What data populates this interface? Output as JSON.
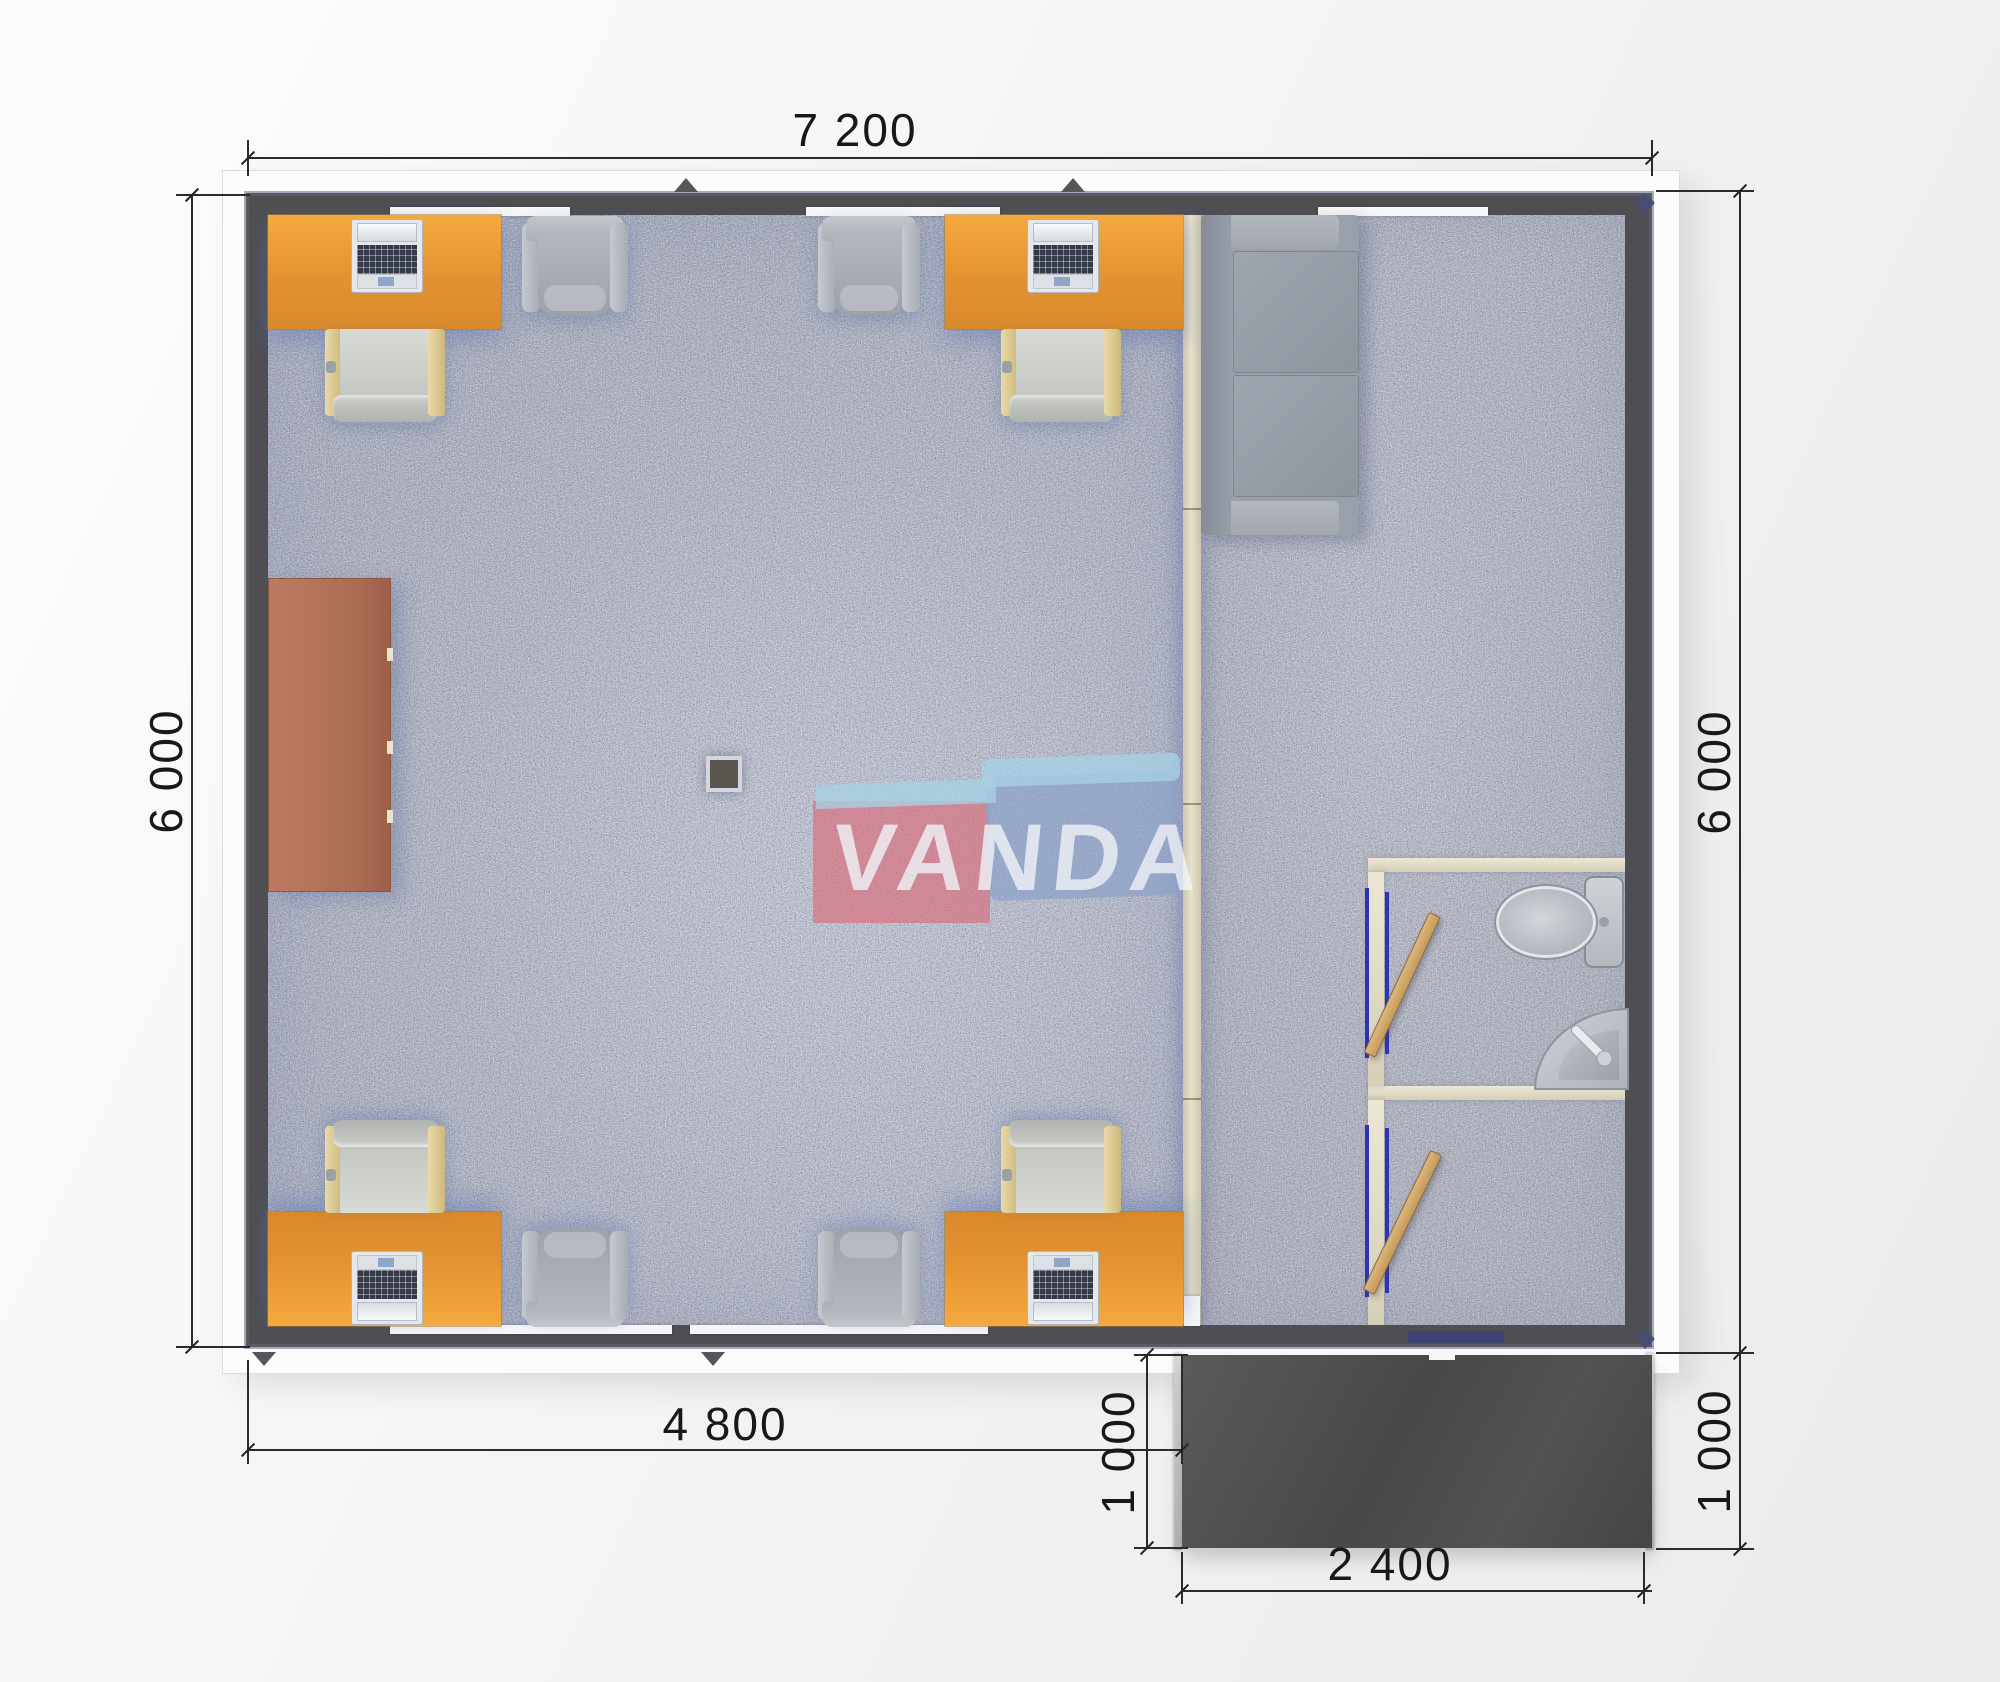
{
  "plan": {
    "type": "modular-office-floor-plan",
    "watermark": {
      "text": "VANDA"
    },
    "dimension_labels": {
      "top_width": "7 200",
      "left_height": "6 000",
      "right_height": "6 000",
      "bottom_office_width": "4 800",
      "porch_depth_left": "1 000",
      "porch_depth_right": "1 000",
      "porch_width": "2 400"
    },
    "colors": {
      "wall": "#4f4f53",
      "carpet": "#b7bac6",
      "desk": "#e49330",
      "sideboard": "#b2715a",
      "partition": "#ded7c2",
      "door_leaf": "#cfa061",
      "door_frame": "#3a3fb8",
      "porch": "#4b4b4d",
      "watermark_pink": "#d9707e",
      "watermark_blue": "#8aa0c8",
      "watermark_sky": "#a6d3e6"
    },
    "furniture": [
      {
        "name": "office-desk-with-computer",
        "count": 4
      },
      {
        "name": "task-chair",
        "count": 4
      },
      {
        "name": "armchair",
        "count": 4
      },
      {
        "name": "sideboard",
        "count": 1
      },
      {
        "name": "sofa",
        "count": 1
      },
      {
        "name": "toilet",
        "count": 1
      },
      {
        "name": "corner-sink",
        "count": 1
      },
      {
        "name": "swing-door",
        "count": 2
      },
      {
        "name": "column",
        "count": 1
      }
    ]
  }
}
